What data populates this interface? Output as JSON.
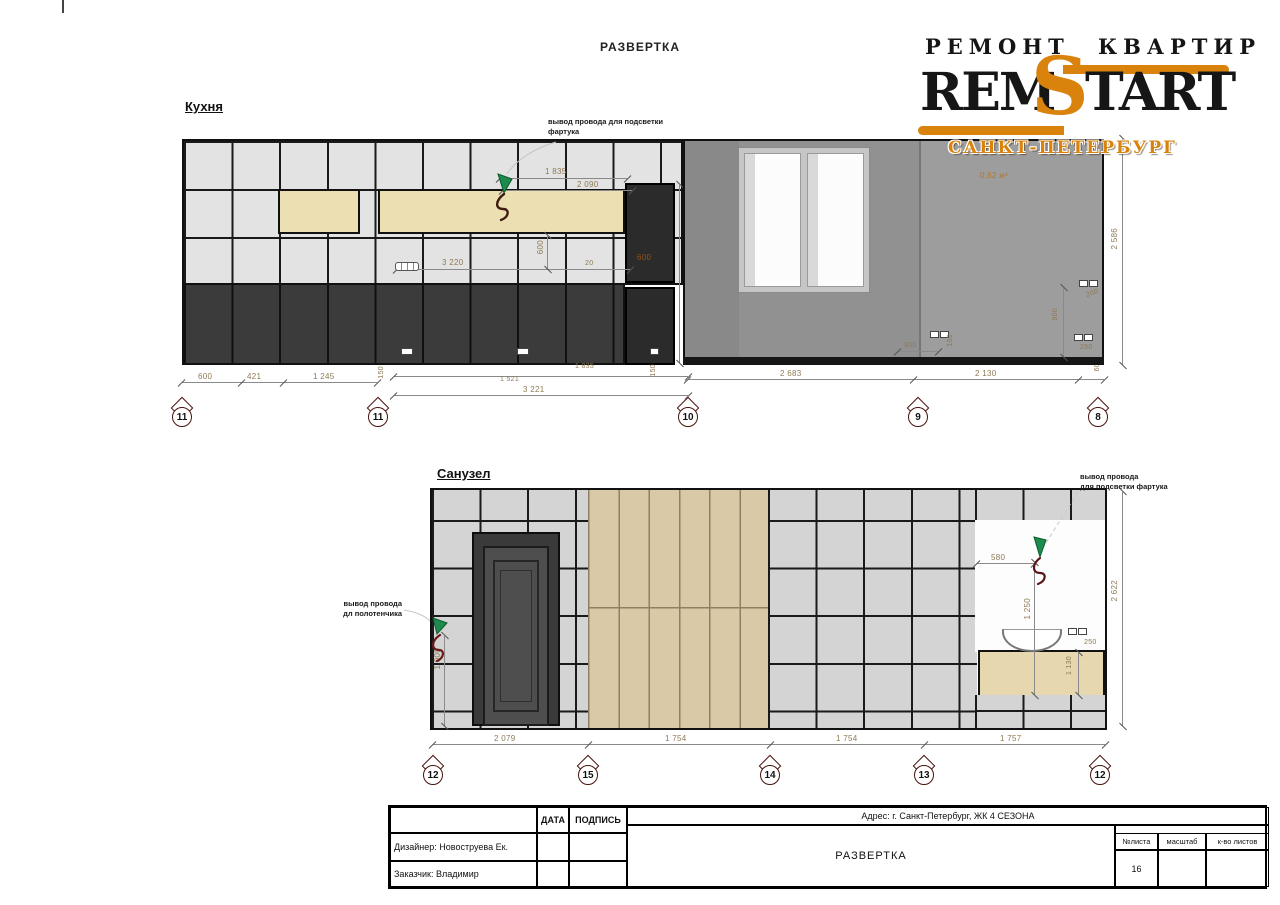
{
  "page": {
    "title": "РАЗВЕРТКА"
  },
  "logo": {
    "top_left": "РЕМОНТ",
    "top_right": "КВАРТИР",
    "brand_rem": "REM",
    "brand_s": "S",
    "brand_tart": "TART",
    "city": "САНКТ-ПЕТЕРБУРГ",
    "accent": "#d9830c"
  },
  "kitchen": {
    "label": "Кухня",
    "wire_note_l1": "вывод провода для подсветки",
    "wire_note_l2": "фартука",
    "area_note": "0,62 м²",
    "cabinet_note": "600",
    "dims": {
      "top_a": "1 835",
      "top_b": "2 090",
      "mid_w": "3 220",
      "mid_h": "600",
      "mid_off": "20",
      "h_right": "2 586",
      "s300": "300",
      "s150": "150",
      "s900": "900",
      "s200": "200",
      "s250": "250",
      "edge60": "60",
      "gap150a": "150",
      "gap150b": "150",
      "len1521": "1 521",
      "len1835": "1 835",
      "total": "3 221",
      "seg600": "600",
      "seg421": "421",
      "seg1245": "1 245",
      "seg2683": "2 683",
      "seg2130": "2 130"
    },
    "markers": [
      "11",
      "11",
      "10",
      "9",
      "8"
    ]
  },
  "bathroom": {
    "label": "Санузел",
    "towel_note_l1": "вывод провода",
    "towel_note_l2": "дл полотенчика",
    "apron_note_l1": "вывод провода",
    "apron_note_l2": "для подсветки фартука",
    "dims": {
      "towel_h": "1 000",
      "apron_w": "580",
      "apron_h": "1 250",
      "h_right": "2 622",
      "s250": "250",
      "vanity_h": "1 130",
      "seg1": "2 079",
      "seg2": "1 754",
      "seg3": "1 754",
      "seg4": "1 757"
    },
    "markers": [
      "12",
      "15",
      "14",
      "13",
      "12"
    ]
  },
  "titleblock": {
    "col_date": "ДАТА",
    "col_sign": "ПОДПИСЬ",
    "designer": "Дизайнер: Новоструева Ек.",
    "client": "Заказчик: Владимир",
    "address": "Адрес: г. Санкт-Петербург, ЖК 4 СЕЗОНА",
    "drawing_title": "РАЗВЕРТКА",
    "sheet_no_label": "№листа",
    "scale_label": "масштаб",
    "sheets_label": "к-во листов",
    "sheet_no": "16"
  }
}
